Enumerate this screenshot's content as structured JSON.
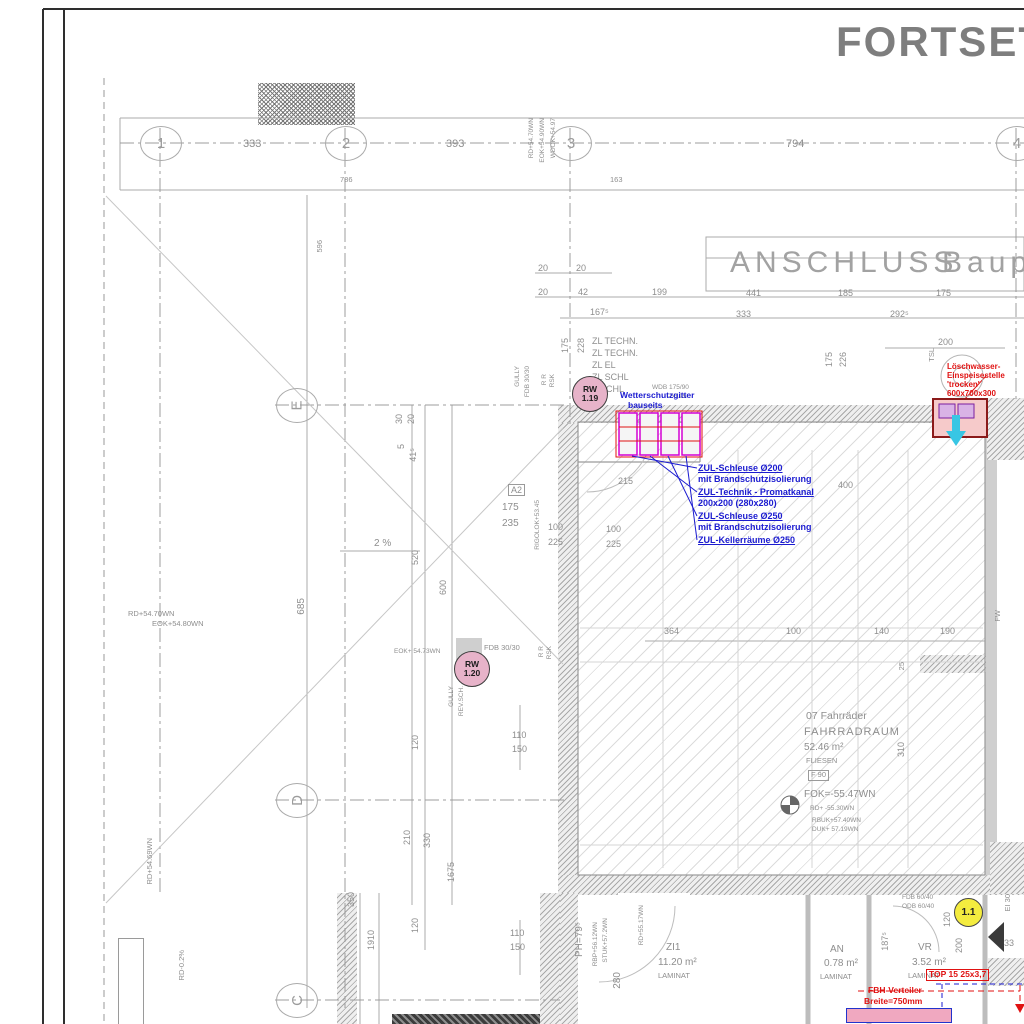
{
  "hdr": {
    "title": "FORTSETZ"
  },
  "band": {
    "a": "ANSCHLUSS",
    "b": "Baupl"
  },
  "ax": {
    "c1": "1",
    "c2": "2",
    "c3": "3",
    "c4": "4",
    "rE": "E",
    "rD": "D",
    "rC": "C"
  },
  "d": {
    "d333": "333",
    "d393": "393",
    "d794": "794",
    "d786": "786",
    "d163": "163",
    "d20a": "20",
    "d20b": "20",
    "d20c": "20",
    "d42": "42",
    "d199": "199",
    "d1675s": "167⁵",
    "d441": "441",
    "d185": "185",
    "d175": "175",
    "d333b": "333",
    "d2925": "292⁵",
    "d200": "200",
    "d175v": "175",
    "d228": "228",
    "d175w": "175",
    "d226": "226",
    "d596": "596",
    "d685": "685",
    "d30": "30",
    "d20d": "20",
    "d5": "5",
    "d415": "41⁵",
    "d520": "520",
    "d600": "600",
    "d120a": "120",
    "d210": "210",
    "d330": "330",
    "d1675": "1675",
    "d350": "350",
    "d1910": "1910",
    "d120b": "120",
    "d110a": "110",
    "d150a": "150",
    "d110b": "110",
    "d150b": "150",
    "d215": "215",
    "d100a": "100",
    "d225a": "225",
    "d100b": "100",
    "d225b": "225",
    "d400": "400",
    "d175c": "175",
    "d235": "235",
    "d364": "364",
    "d100c": "100",
    "d140": "140",
    "d190": "190",
    "d310": "310",
    "d280": "280",
    "d1875": "187⁵",
    "d120c": "120",
    "d200b": "200",
    "d33": "33",
    "d25": "25"
  },
  "elev": {
    "rd5470a": "RD+54.70WN",
    "eok5490": "EOK+54.90WN",
    "wdok": "WDOK+54.97",
    "rd5470b": "RD+54.70WN",
    "eok5480": "EOK+54.80WN",
    "rd5469": "RD+54.69WN",
    "rd02": "RD-0.2%",
    "eok5473": "EOK+ 54.73WN",
    "fdb3030": "FDB 30/30",
    "rigol": "RIGOLOK+53.45",
    "wdb": "WDB 175/90",
    "wdb2": "-55.95",
    "fok": "FOK=-55.47WN",
    "rdm5530": "RD+ -55.30WN",
    "rbuk": "RBUK+57.40WN",
    "duk": "DUK+ 57.19WN",
    "ph79": "PH=79⁵",
    "rbp": "RBP+56.12WN",
    "stuk": "STUK+57.2WN",
    "rd5517": "RD+55.17WN",
    "fdb6040": "FDB 60/40",
    "odb6040": "ODB 60/40",
    "slope": "2 %"
  },
  "vent": {
    "l1": "ZL TECHN.",
    "l2": "ZL TECHN.",
    "l3": "ZL EL",
    "l4": "ZL SCHL",
    "l5": "SCHL",
    "wsg1": "Wetterschutzgitter",
    "wsg2": "bauseits"
  },
  "zul": {
    "a1": "ZUL-Schleuse Ø200",
    "a2": "mit Brandschutzisolierung",
    "b1": "ZUL-Technik - Promatkanal",
    "b2": "200x200 (280x280)",
    "c1": "ZUL-Schleuse Ø250",
    "c2": "mit Brandschutzisolierung",
    "e1": "ZUL-Kellerräume Ø250"
  },
  "loesch": {
    "l1": "Löschwasser-",
    "l2": "Einspeisestelle",
    "l3": "'trocken'",
    "l4": "600x700x300"
  },
  "rooms": {
    "bike1": "07 Fahrräder",
    "bike2": "FAHRRADRAUM",
    "bike3": "52.46 m²",
    "bike4": "FLIESEN",
    "bike5": "F 90",
    "zi1": "ZI1",
    "zi1a": "11.20 m²",
    "zi1b": "LAMINAT",
    "an": "AN",
    "ana": "0.78 m²",
    "anb": "LAMINAT",
    "vr": "VR",
    "vra": "3.52 m²",
    "vrb": "LAMINAT"
  },
  "marks": {
    "rw1a": "RW",
    "rw1b": "1.19",
    "rw2a": "RW",
    "rw2b": "1.20",
    "pos": "1.1",
    "a2": "A2",
    "tsl": "TSL",
    "fw": "FW",
    "ei30": "EI 30",
    "gully1": "GULLY",
    "gfdb": "FDB 30/30",
    "rr1": "R R",
    "rsk1": "RSK",
    "rr2": "R R",
    "rsk2": "RSK",
    "gully2": "GULLY",
    "rev": "REV.SCH."
  },
  "fbh": {
    "t1": "TOP 15  25x3,7",
    "f1": "FBH-Verteiler",
    "f2": "Breite=750mm"
  },
  "colors": {
    "note_blue": "#1b1bd0",
    "note_red": "#e01212",
    "grille_magenta": "#d400d4",
    "marker_pink": "#e7b3c9",
    "marker_yellow": "#f4ec3f",
    "cyan_arrow": "#38c6e4"
  }
}
